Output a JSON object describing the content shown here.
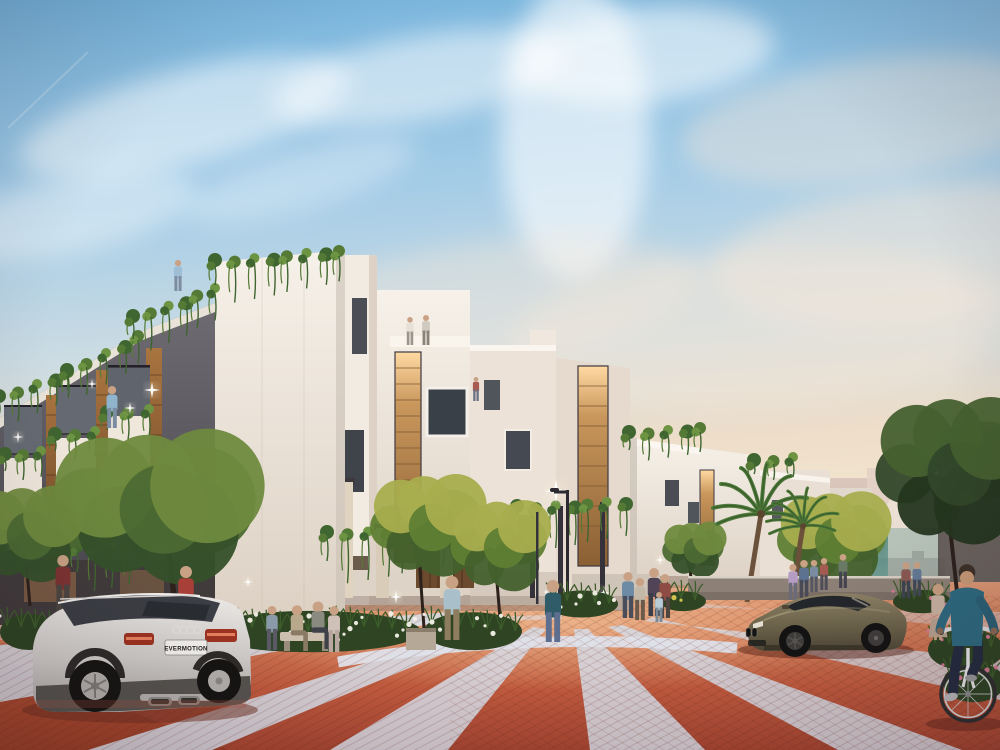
{
  "meta": {
    "title": "Architectural rendering: modern townhouse street at dusk",
    "width": 1000,
    "height": 750
  },
  "scene": {
    "description": "Row of white and grey modern townhouses with hanging vines, terracotta paved plaza with light diagonal stripes, silver estate car, olive coupe, cyclist, palm trees and pedestrians under a pastel dusk sky",
    "license_plate": {
      "text": "EVERMOTION"
    },
    "palette": {
      "sky_blue": "#8fbede",
      "sky_warm": "#f4e6cf",
      "terracotta": "#c96a4b",
      "paving_stripe": "#d6d9e2",
      "building_white": "#f2ece4",
      "building_grey": "#5b575e",
      "wood": "#9a6a40",
      "foliage": "#5d7a38",
      "foliage_lit": "#a8ad4e",
      "teal_glass": "#4d8a80",
      "car_silver": "#d5d2cf",
      "car_olive": "#6e6449",
      "tail_light": "#c0402c"
    },
    "objects": [
      "townhouse-row-left",
      "white-villa-cluster",
      "receding-villas-right",
      "distant-city-haze",
      "construction-crane",
      "teal-glass-fence",
      "palm-trees",
      "street-trees",
      "paved-plaza",
      "audi-estate-car",
      "olive-coupe",
      "cyclist",
      "street-lamp",
      "planter-beds",
      "pedestrians"
    ]
  },
  "clouds": [
    {
      "cx": 185,
      "cy": 118,
      "rx": 170,
      "ry": 48,
      "rot": -14,
      "o": 0.5,
      "warm": false
    },
    {
      "cx": 70,
      "cy": 215,
      "rx": 130,
      "ry": 38,
      "rot": -12,
      "o": 0.4,
      "warm": false
    },
    {
      "cx": 420,
      "cy": 78,
      "rx": 150,
      "ry": 42,
      "rot": -10,
      "o": 0.5,
      "warm": false
    },
    {
      "cx": 575,
      "cy": 130,
      "rx": 75,
      "ry": 150,
      "rot": 0,
      "o": 0.6,
      "warm": false
    },
    {
      "cx": 645,
      "cy": 55,
      "rx": 130,
      "ry": 48,
      "rot": -6,
      "o": 0.55,
      "warm": false
    },
    {
      "cx": 870,
      "cy": 120,
      "rx": 190,
      "ry": 60,
      "rot": -8,
      "o": 0.4,
      "warm": true
    },
    {
      "cx": 920,
      "cy": 255,
      "rx": 210,
      "ry": 70,
      "rot": -6,
      "o": 0.45,
      "warm": true
    },
    {
      "cx": 760,
      "cy": 330,
      "rx": 250,
      "ry": 80,
      "rot": -4,
      "o": 0.4,
      "warm": true
    },
    {
      "cx": 300,
      "cy": 180,
      "rx": 120,
      "ry": 30,
      "rot": -16,
      "o": 0.3,
      "warm": false
    },
    {
      "cx": 500,
      "cy": 300,
      "rx": 200,
      "ry": 60,
      "rot": -6,
      "o": 0.35,
      "warm": true
    }
  ],
  "street": {
    "stripes": [
      {
        "pts": "0,645 452,612 466,617 0,702",
        "o": 0.9
      },
      {
        "pts": "88,750 494,623 508,627 212,750",
        "o": 0.9
      },
      {
        "pts": "330,750 533,627 546,629 448,750",
        "o": 0.88
      },
      {
        "pts": "590,750 574,629 588,629 705,750",
        "o": 0.88
      },
      {
        "pts": "838,750 608,627 622,625 962,750",
        "o": 0.88
      },
      {
        "pts": "1000,660 645,621 652,617 1000,700",
        "o": 0.8
      },
      {
        "pts": "1000,612 700,608 704,604 1000,630",
        "o": 0.45
      },
      {
        "pts": "0,622 300,606 306,609 0,640",
        "o": 0.4
      }
    ],
    "curves": [
      {
        "d": "M338,662 Q520,630 737,648",
        "w": 11,
        "o": 0.95
      },
      {
        "d": "M240,641 Q430,619 562,617",
        "w": 4.5,
        "o": 0.55
      }
    ]
  },
  "vines": [
    {
      "x1": 2,
      "y1": 398,
      "x2": 70,
      "y2": 372,
      "n": 5,
      "drop": 26
    },
    {
      "x1": 70,
      "y1": 372,
      "x2": 140,
      "y2": 336,
      "n": 5,
      "drop": 28
    },
    {
      "x1": 136,
      "y1": 318,
      "x2": 215,
      "y2": 290,
      "n": 6,
      "drop": 34
    },
    {
      "x1": 218,
      "y1": 262,
      "x2": 342,
      "y2": 252,
      "n": 8,
      "drop": 38
    },
    {
      "x1": 8,
      "y1": 456,
      "x2": 40,
      "y2": 452,
      "n": 3,
      "drop": 22
    },
    {
      "x1": 58,
      "y1": 436,
      "x2": 94,
      "y2": 432,
      "n": 3,
      "drop": 22
    },
    {
      "x1": 110,
      "y1": 414,
      "x2": 148,
      "y2": 410,
      "n": 3,
      "drop": 24
    },
    {
      "x1": 80,
      "y1": 548,
      "x2": 126,
      "y2": 545,
      "n": 4,
      "drop": 40
    },
    {
      "x1": 330,
      "y1": 534,
      "x2": 478,
      "y2": 528,
      "n": 9,
      "drop": 46
    },
    {
      "x1": 520,
      "y1": 508,
      "x2": 624,
      "y2": 503,
      "n": 7,
      "drop": 40
    },
    {
      "x1": 632,
      "y1": 434,
      "x2": 702,
      "y2": 428,
      "n": 5,
      "drop": 24
    },
    {
      "x1": 757,
      "y1": 462,
      "x2": 792,
      "y2": 458,
      "n": 3,
      "drop": 16
    }
  ],
  "trees": [
    {
      "cx": 148,
      "cy": 512,
      "rx": 108,
      "ry": 58,
      "trunk": [
        176,
        612,
        168,
        546
      ],
      "mode": "dusk"
    },
    {
      "cx": 22,
      "cy": 538,
      "rx": 58,
      "ry": 48,
      "trunk": [
        30,
        606,
        26,
        560
      ],
      "mode": "dusk"
    },
    {
      "cx": 424,
      "cy": 530,
      "rx": 58,
      "ry": 56,
      "trunk": [
        424,
        628,
        419,
        556
      ],
      "mode": "lit"
    },
    {
      "cx": 497,
      "cy": 550,
      "rx": 50,
      "ry": 52,
      "trunk": [
        501,
        630,
        496,
        570
      ],
      "mode": "lit"
    },
    {
      "cx": 830,
      "cy": 543,
      "rx": 57,
      "ry": 48,
      "trunk": [
        828,
        614,
        823,
        562
      ],
      "mode": "lit"
    },
    {
      "cx": 948,
      "cy": 478,
      "rx": 78,
      "ry": 88,
      "trunk": [
        957,
        592,
        949,
        518
      ],
      "mode": "dark"
    },
    {
      "cx": 692,
      "cy": 552,
      "rx": 32,
      "ry": 30,
      "trunk": [
        693,
        600,
        690,
        568
      ],
      "mode": "dusk"
    }
  ],
  "palms": [
    {
      "x": 761,
      "y": 514,
      "r": 50,
      "tx": 747,
      "ty": 602
    },
    {
      "x": 803,
      "y": 526,
      "r": 38,
      "tx": 796,
      "ty": 600
    }
  ],
  "beds": [
    {
      "x": 203,
      "y": 604,
      "w": 218,
      "h": 46,
      "f": "white"
    },
    {
      "x": 424,
      "y": 606,
      "w": 98,
      "h": 42,
      "f": "white"
    },
    {
      "x": 546,
      "y": 586,
      "w": 72,
      "h": 30,
      "f": "white"
    },
    {
      "x": 0,
      "y": 608,
      "w": 58,
      "h": 40,
      "f": "white"
    },
    {
      "x": 893,
      "y": 586,
      "w": 58,
      "h": 26,
      "f": "pink"
    },
    {
      "x": 928,
      "y": 622,
      "w": 76,
      "h": 46,
      "f": "pink"
    },
    {
      "x": 943,
      "y": 656,
      "w": 62,
      "h": 44,
      "f": "pink"
    },
    {
      "x": 660,
      "y": 588,
      "w": 46,
      "h": 22,
      "f": "yellow"
    }
  ],
  "sparkles": [
    {
      "x": 152,
      "y": 390,
      "s": 1
    },
    {
      "x": 63,
      "y": 476,
      "s": 0.8
    },
    {
      "x": 228,
      "y": 522,
      "s": 0.9
    },
    {
      "x": 130,
      "y": 408,
      "s": 0.7
    },
    {
      "x": 18,
      "y": 437,
      "s": 0.7
    },
    {
      "x": 92,
      "y": 384,
      "s": 0.6
    },
    {
      "x": 556,
      "y": 491,
      "s": 1.4
    },
    {
      "x": 604,
      "y": 593,
      "s": 0.9
    },
    {
      "x": 396,
      "y": 597,
      "s": 0.8
    },
    {
      "x": 248,
      "y": 582,
      "s": 0.6
    },
    {
      "x": 660,
      "y": 560,
      "s": 0.6
    },
    {
      "x": 438,
      "y": 528,
      "s": 0.7
    }
  ],
  "people": [
    {
      "x": 63,
      "y": 612,
      "h": 57,
      "top": "#7c3332",
      "bottom": "#4c4642"
    },
    {
      "x": 186,
      "y": 626,
      "h": 60,
      "top": "#a84038",
      "bottom": "#5c6678"
    },
    {
      "x": 178,
      "y": 291,
      "h": 31,
      "top": "#9fbdd4",
      "bottom": "#7d8ca0"
    },
    {
      "x": 112,
      "y": 428,
      "h": 42,
      "top": "#8fb4cc",
      "bottom": "#7b8ca0"
    },
    {
      "x": 410,
      "y": 345,
      "h": 28,
      "top": "#e6e0d6",
      "bottom": "#9a948a"
    },
    {
      "x": 426,
      "y": 345,
      "h": 30,
      "top": "#cfc9bf",
      "bottom": "#8a8478"
    },
    {
      "x": 476,
      "y": 401,
      "h": 24,
      "top": "#a85a50",
      "bottom": "#6a7082"
    },
    {
      "x": 297,
      "y": 651,
      "h": 52,
      "top": "#b9a98c",
      "bottom": "#8a7a64",
      "pose": "sit"
    },
    {
      "x": 318,
      "y": 649,
      "h": 54,
      "top": "#8a8a80",
      "bottom": "#3e4248",
      "pose": "sit"
    },
    {
      "x": 272,
      "y": 650,
      "h": 44,
      "top": "#8a9aa8",
      "bottom": "#5a5a66"
    },
    {
      "x": 334,
      "y": 652,
      "h": 46,
      "top": "#cfc0b8",
      "bottom": "#b8a8a0"
    },
    {
      "x": 452,
      "y": 640,
      "h": 64,
      "top": "#a9c0cb",
      "bottom": "#8d7c5e"
    },
    {
      "x": 553,
      "y": 642,
      "h": 62,
      "top": "#2f5c68",
      "bottom": "#5d6e8e"
    },
    {
      "x": 628,
      "y": 618,
      "h": 46,
      "top": "#6d8ba4",
      "bottom": "#4a4e5a"
    },
    {
      "x": 640,
      "y": 620,
      "h": 42,
      "top": "#c4b8a6",
      "bottom": "#6a5a4c"
    },
    {
      "x": 654,
      "y": 616,
      "h": 48,
      "top": "#514457",
      "bottom": "#3a3e48"
    },
    {
      "x": 665,
      "y": 618,
      "h": 44,
      "top": "#8e4c44",
      "bottom": "#4e4440"
    },
    {
      "x": 659,
      "y": 622,
      "h": 30,
      "top": "#b8ccd8",
      "bottom": "#7a8a96"
    },
    {
      "x": 793,
      "y": 600,
      "h": 36,
      "top": "#b49cc2",
      "bottom": "#6a6a78"
    },
    {
      "x": 804,
      "y": 598,
      "h": 38,
      "top": "#5c7290",
      "bottom": "#4a4a56"
    },
    {
      "x": 814,
      "y": 592,
      "h": 32,
      "top": "#7c8ca0",
      "bottom": "#565660"
    },
    {
      "x": 824,
      "y": 590,
      "h": 32,
      "top": "#a45a50",
      "bottom": "#4e4e58"
    },
    {
      "x": 843,
      "y": 588,
      "h": 34,
      "top": "#6a7a66",
      "bottom": "#44444e"
    },
    {
      "x": 906,
      "y": 598,
      "h": 36,
      "top": "#8a5a52",
      "bottom": "#3e4450"
    },
    {
      "x": 917,
      "y": 596,
      "h": 34,
      "top": "#647a96",
      "bottom": "#434956"
    },
    {
      "x": 938,
      "y": 640,
      "h": 56,
      "top": "#c9b3a2",
      "bottom": "#b9a290",
      "pose": "dress"
    }
  ]
}
